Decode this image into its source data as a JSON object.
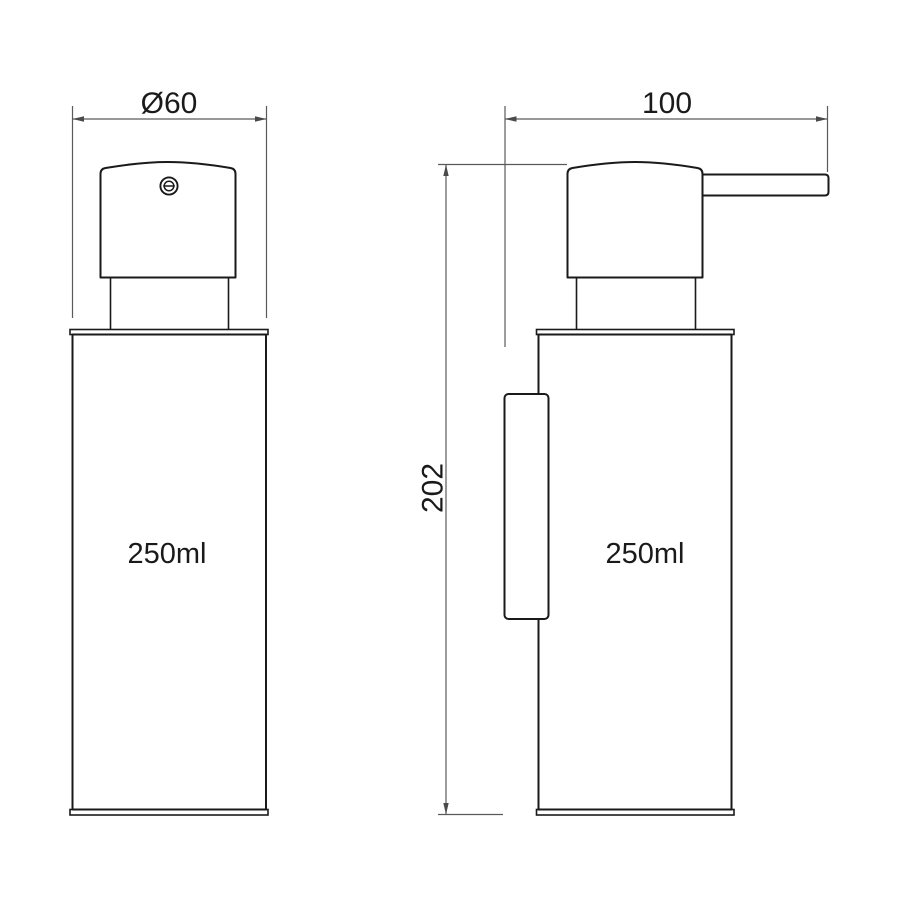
{
  "drawing": {
    "front_view": {
      "capacity_label": "250ml"
    },
    "side_view": {
      "capacity_label": "250ml"
    },
    "dimensions": {
      "diameter_label": "Ø60",
      "width_label": "100",
      "height_label": "202"
    },
    "icons": {
      "pump_cap": "screw-slot-icon"
    },
    "colors": {
      "background": "#ffffff",
      "outline": "#1a1a1a",
      "dimension_lines": "#5a5a5a",
      "text": "#1a1a1a"
    }
  }
}
